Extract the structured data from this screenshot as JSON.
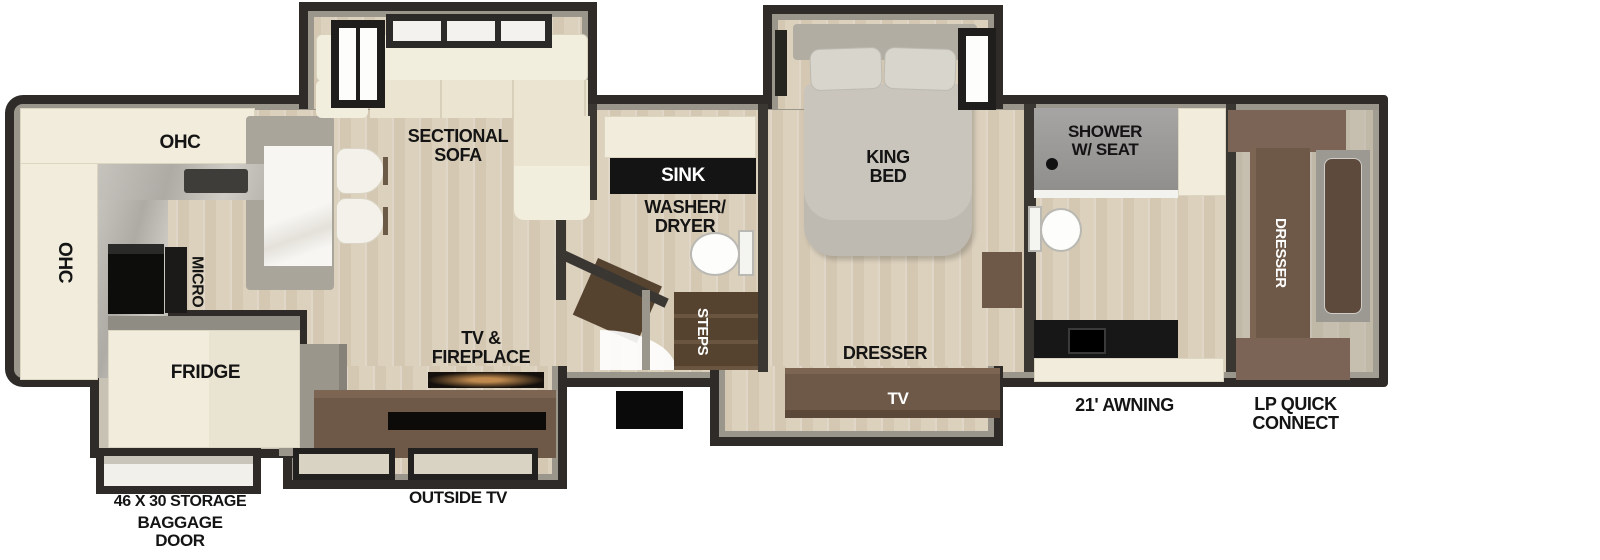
{
  "palette": {
    "wall": "#2e2b28",
    "wall_face": "#9a968c",
    "floor": "#dcd1bd",
    "cabinet": "#f1ecdc",
    "counter_black": "#141414",
    "marble_gray": "#b7b3ab",
    "marble_white": "#f6f5f1",
    "brown": "#6e5847",
    "brown_dark": "#55432f",
    "shower": "#a09f9d",
    "bed": "#c9c5bc",
    "appliance_black": "#0d0d0c",
    "label": "#141414"
  },
  "labels": {
    "ohc_top": "OHC",
    "ohc_left": "OHC",
    "micro": "MICRO",
    "fridge": "FRIDGE",
    "sectional_sofa": "SECTIONAL\nSOFA",
    "tv_fireplace": "TV &\nFIREPLACE",
    "sink": "SINK",
    "washer_dryer": "WASHER/\nDRYER",
    "steps": "STEPS",
    "king_bed": "KING\nBED",
    "dresser_bedroom": "DRESSER",
    "tv_bedroom": "TV",
    "shower_seat": "SHOWER\nW/ SEAT",
    "dresser_rear": "DRESSER",
    "storage": "46 X 30 STORAGE",
    "baggage_door": "BAGGAGE\nDOOR",
    "outside_tv": "OUTSIDE TV",
    "awning": "21' AWNING",
    "lp_quick_connect": "LP QUICK\nCONNECT"
  }
}
